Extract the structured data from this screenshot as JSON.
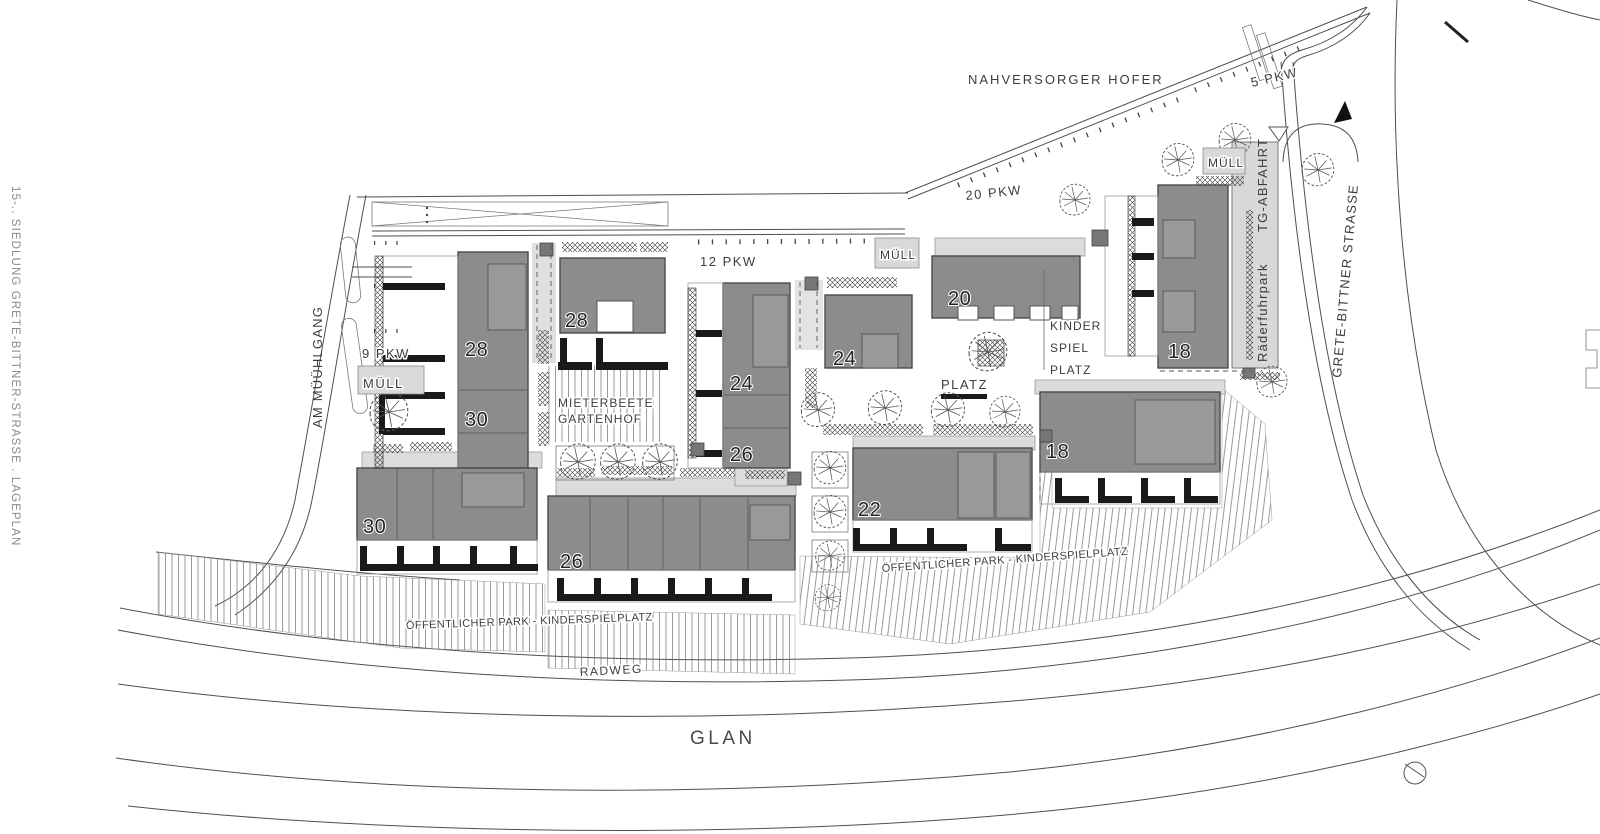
{
  "document": {
    "side_title": "15-.. SIEDLUNG GRETE-BITTNER-STRASSE . LAGEPLAN"
  },
  "streets": {
    "glan": "GLAN",
    "radweg": "RADWEG",
    "grete_bittner": "GRETE-BITTNER STRASSE",
    "am_muehlgang": "AM MÜÜHLGANG",
    "nahversorger": "NAHVERSORGER HOFER"
  },
  "parking": {
    "pkw5": "5 PKW",
    "pkw9": "9 PKW",
    "pkw12": "12 PKW",
    "pkw20": "20 PKW"
  },
  "facilities": {
    "tg_abfahrt": "TG-ABFAHRT",
    "raederfuhrpark": "Räderfuhrpark",
    "muell_top": "MÜLL",
    "muell_center": "MÜLL",
    "muell_left": "MÜLL",
    "mieterbeete": "MIETERBEETE",
    "gartenhof": "GARTENHOF",
    "platz": "PLATZ",
    "kinder_line1": "KINDER",
    "kinder_line2": "SPIEL",
    "kinder_line3": "PLATZ",
    "park_label_left": "ÖFFENTLICHER PARK - KINDERSPIELPLATZ",
    "park_label_right": "ÖFFENTLICHER PARK - KINDERSPIELPLATZ"
  },
  "buildings": {
    "b28_slab": "28",
    "b30_slab": "30",
    "b28_hof": "28",
    "b30_row": "30",
    "b26_row": "26",
    "b24_slab": "24",
    "b26_slab": "26",
    "b24_hof": "24",
    "b22": "22",
    "b20": "20",
    "b18_top": "18",
    "b18_mid": "18"
  },
  "colors": {
    "building_fill": "#8c8c8c",
    "building_stroke": "#4a4a4a",
    "paving_light": "#dcdcdc",
    "line": "#4f4f4f",
    "text": "#3d3d3d",
    "background": "#ffffff"
  }
}
